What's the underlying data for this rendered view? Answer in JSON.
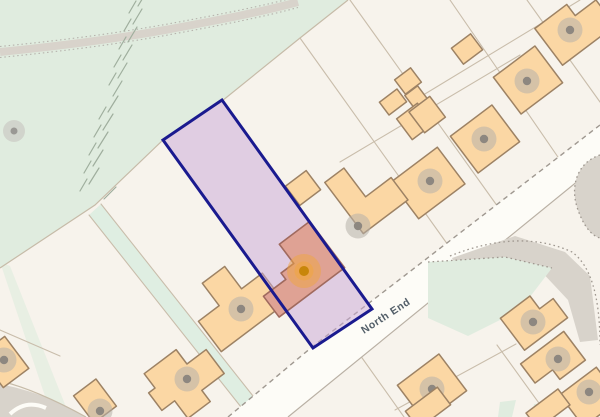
{
  "map": {
    "type": "property-location-plan",
    "road": {
      "label": "North End",
      "label_rotation_deg": -33
    },
    "selected_plot": {
      "shape": "rotated-rectangle",
      "fill_opacity": 0.5,
      "border_width_px": 3
    },
    "icons": {
      "property_marker": "orange-glow-dot",
      "tree": "gray-canopy-dot",
      "building_marker": "gray-canopy-dot"
    }
  },
  "colors": {
    "background": "#f7f3ec",
    "greenspace": "#e0ecdf",
    "green-strip": "#dfeee2",
    "road-surface": "#fdfcf7",
    "building-fill": "#fbd7a4",
    "building-stroke": "#9d8264",
    "plot-fill": "#c9a8d8",
    "plot-border": "#1a1a8f",
    "highlight-building-fill": "#dfa294",
    "highlight-building-stroke": "#a06a5e",
    "marker-orange": "#c8860a",
    "marker-orange-glow": "#f0a63f",
    "dot-outer": "#b7b1aa",
    "dot-inner": "#8d8780",
    "tree-outer": "#c6c4c0",
    "tree-inner": "#9a9894",
    "path-gray": "#d8d3cb",
    "path-edge": "#b6b2ac",
    "boundary-line": "#c9bdab",
    "green-edge": "#c6bba8",
    "road-edge": "#9f9890",
    "road-edge-solid": "#b9b0a4",
    "hachure": "#9fae9d",
    "label-color": "#525e68"
  }
}
